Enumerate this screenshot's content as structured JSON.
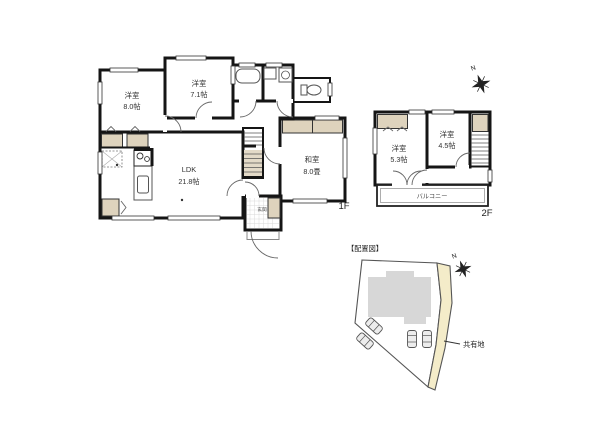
{
  "floor1": {
    "label": "1F",
    "rooms": {
      "bedroom_a": {
        "name": "洋室",
        "size": "8.0帖"
      },
      "bedroom_b": {
        "name": "洋室",
        "size": "7.1帖"
      },
      "ldk": {
        "name": "LDK",
        "size": "21.8帖"
      },
      "washitsu": {
        "name": "和室",
        "size": "8.0畳"
      },
      "genkan": {
        "name": "玄関"
      }
    }
  },
  "floor2": {
    "label": "2F",
    "rooms": {
      "bedroom_c": {
        "name": "洋室",
        "size": "5.3帖"
      },
      "bedroom_d": {
        "name": "洋室",
        "size": "4.5帖"
      },
      "balcony": {
        "name": "バルコニー"
      }
    }
  },
  "site_plan": {
    "title": "【配置図】",
    "shared_area_label": "共有地"
  },
  "compass": {
    "label": "N"
  },
  "colors": {
    "room_pink": "#f9e2de",
    "tatami_green": "#dee9d8",
    "wet_blue": "#cfe3f0",
    "closet_tan": "#ded3bd",
    "road_tan": "#f4ecc9",
    "building_gray": "#d7d7d7",
    "wall": "#151515"
  }
}
